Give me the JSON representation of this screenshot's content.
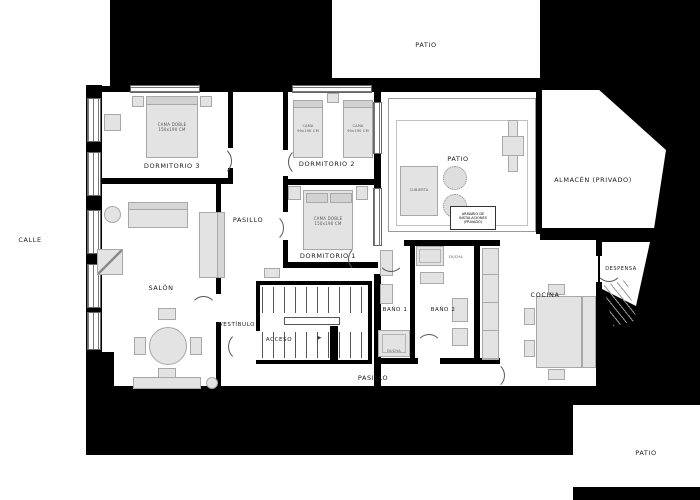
{
  "colors": {
    "background": "#ffffff",
    "mass": "#000000",
    "wall": "#000000",
    "furniture_fill": "#e3e3e3",
    "furniture_border": "#a8a8a8",
    "label_text": "#1a1a1a"
  },
  "rooms": {
    "dormitorio3": {
      "label": "DORMITORIO 3"
    },
    "dormitorio2": {
      "label": "DORMITORIO 2"
    },
    "dormitorio1": {
      "label": "DORMITORIO 1"
    },
    "pasillo_norte": {
      "label": "PASILLO"
    },
    "pasillo_sur": {
      "label": "PASILLO"
    },
    "salon": {
      "label": "SALÓN"
    },
    "vestibulo": {
      "label": "VESTÍBULO"
    },
    "acceso": {
      "label": "ACCESO"
    },
    "bano1": {
      "label": "BAÑO 1"
    },
    "bano2": {
      "label": "BAÑO 2"
    },
    "cocina": {
      "label": "COCINA"
    },
    "despensa": {
      "label": "DESPENSA"
    },
    "almacen": {
      "label": "ALMACÉN (PRIVADO)"
    },
    "patio_central": {
      "label": "PATIO"
    },
    "patio_norte": {
      "label": "PATIO"
    },
    "patio_sureste": {
      "label": "PATIO"
    },
    "calle": {
      "label": "CALLE"
    }
  },
  "furniture": {
    "cama_doble": {
      "line1": "CAMA DOBLE",
      "line2": "150x190 CM"
    },
    "cama_individual": {
      "line1": "CAMA",
      "line2": "90x190 CM"
    },
    "ducha": {
      "label": "DUCHA"
    },
    "cubierta": {
      "label": "CUBIERTA"
    },
    "armario_instalaciones": {
      "line1": "ARMARIO DE",
      "line2": "INSTALACIONES",
      "line3": "(PRIVADO)"
    }
  }
}
